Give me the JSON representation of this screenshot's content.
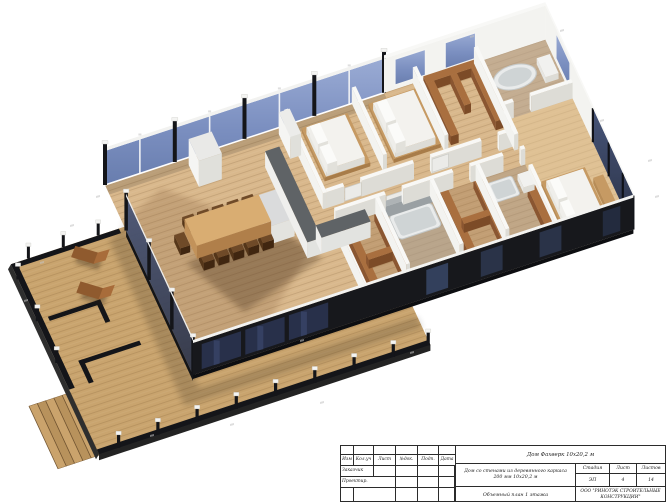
{
  "palette": {
    "deck_wood": "#c9a46e",
    "floor_wood": "#d9b88c",
    "wall_black": "#17181c",
    "glass_blue_light": "#9aabd4",
    "glass_blue": "#7b8fc0",
    "glass_dark": "#2b3246",
    "glass_front": "#28304a",
    "wall_white_top": "#f8f8f6",
    "wall_white_lit": "#f3f3f0",
    "wall_white_shade": "#dddcd6",
    "shelf_brown_side": "#8a5631",
    "shelf_brown_top": "#a96f3f",
    "counter_top": "#5f6366",
    "counter_side": "#efefed",
    "chair_brown": "#553619",
    "chair_brown_top": "#6f4a28",
    "table_top": "#d9ad72",
    "table_side": "#b07f4a",
    "mattress": "#f3f2ee",
    "bed_wood": "#c69a63",
    "tub_white": "#e9ebeb",
    "tub_inner": "#cfd4d5",
    "lounger_brown": "#8f5a2e",
    "lounger_back": "#a86c3a"
  },
  "title_block": {
    "revision_columns": [
      "Изм",
      "Кол.уч",
      "Лист",
      "№док.",
      "Подп.",
      "Дата"
    ],
    "row_customer": "Заказчик",
    "row_designer": "Проектир.",
    "project_title": "Дом Фахверк 10х20,2 м",
    "object_description_line1": "Дом со стенами из деревянного каркаса",
    "object_description_line2": "200 мм 10х20,2 м",
    "stage_label": "Стадия",
    "sheet_label": "Лист",
    "sheets_label": "Листов",
    "stage_value": "ЭП",
    "sheet_value": "4",
    "sheets_value": "14",
    "sheet_name": "Объемный план 1 этажа",
    "company_line1": "ООО \"РИНОТЭК СТРОИТЕЛЬНЫЕ",
    "company_line2": "КОНСТРУКЦИИ\""
  }
}
